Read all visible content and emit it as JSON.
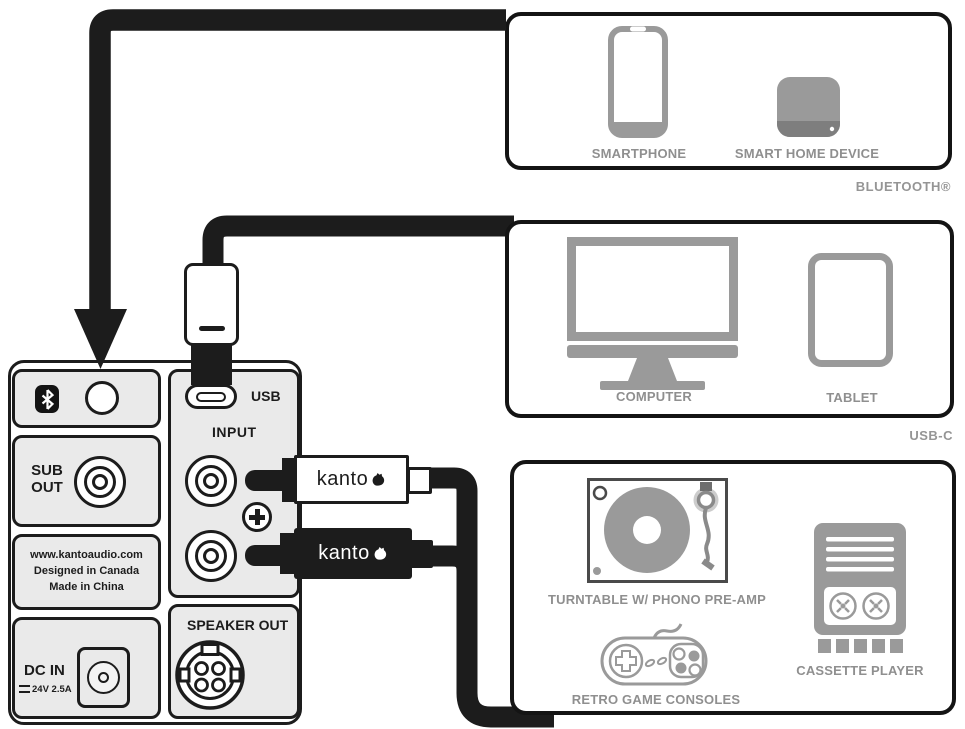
{
  "device_panel": {
    "usb_label": "USB",
    "input_label": "INPUT",
    "speaker_out_label": "SPEAKER OUT",
    "sub_out_label": "SUB OUT",
    "dc_in_label": "DC IN",
    "dc_in_spec": "24V 2.5A",
    "info_lines": [
      "www.kantoaudio.com",
      "Designed in Canada",
      "Made in China"
    ]
  },
  "cables": {
    "rca_white_label": "kanto",
    "rca_black_label": "kanto"
  },
  "sources": {
    "bluetooth": {
      "caption": "BLUETOOTH®",
      "devices": [
        {
          "label": "SMARTPHONE"
        },
        {
          "label": "SMART HOME DEVICE"
        }
      ]
    },
    "usb_c": {
      "caption": "USB-C",
      "devices": [
        {
          "label": "COMPUTER"
        },
        {
          "label": "TABLET"
        }
      ]
    },
    "analog": {
      "devices": [
        {
          "label": "TURNTABLE W/ PHONO PRE-AMP"
        },
        {
          "label": "RETRO GAME CONSOLES"
        },
        {
          "label": "CASSETTE PLAYER"
        }
      ]
    }
  },
  "colors": {
    "line": "#1c1c1c",
    "icon_gray": "#9a9a9a",
    "label_gray": "#8f8f8f",
    "panel_fill": "#eaeaea"
  }
}
